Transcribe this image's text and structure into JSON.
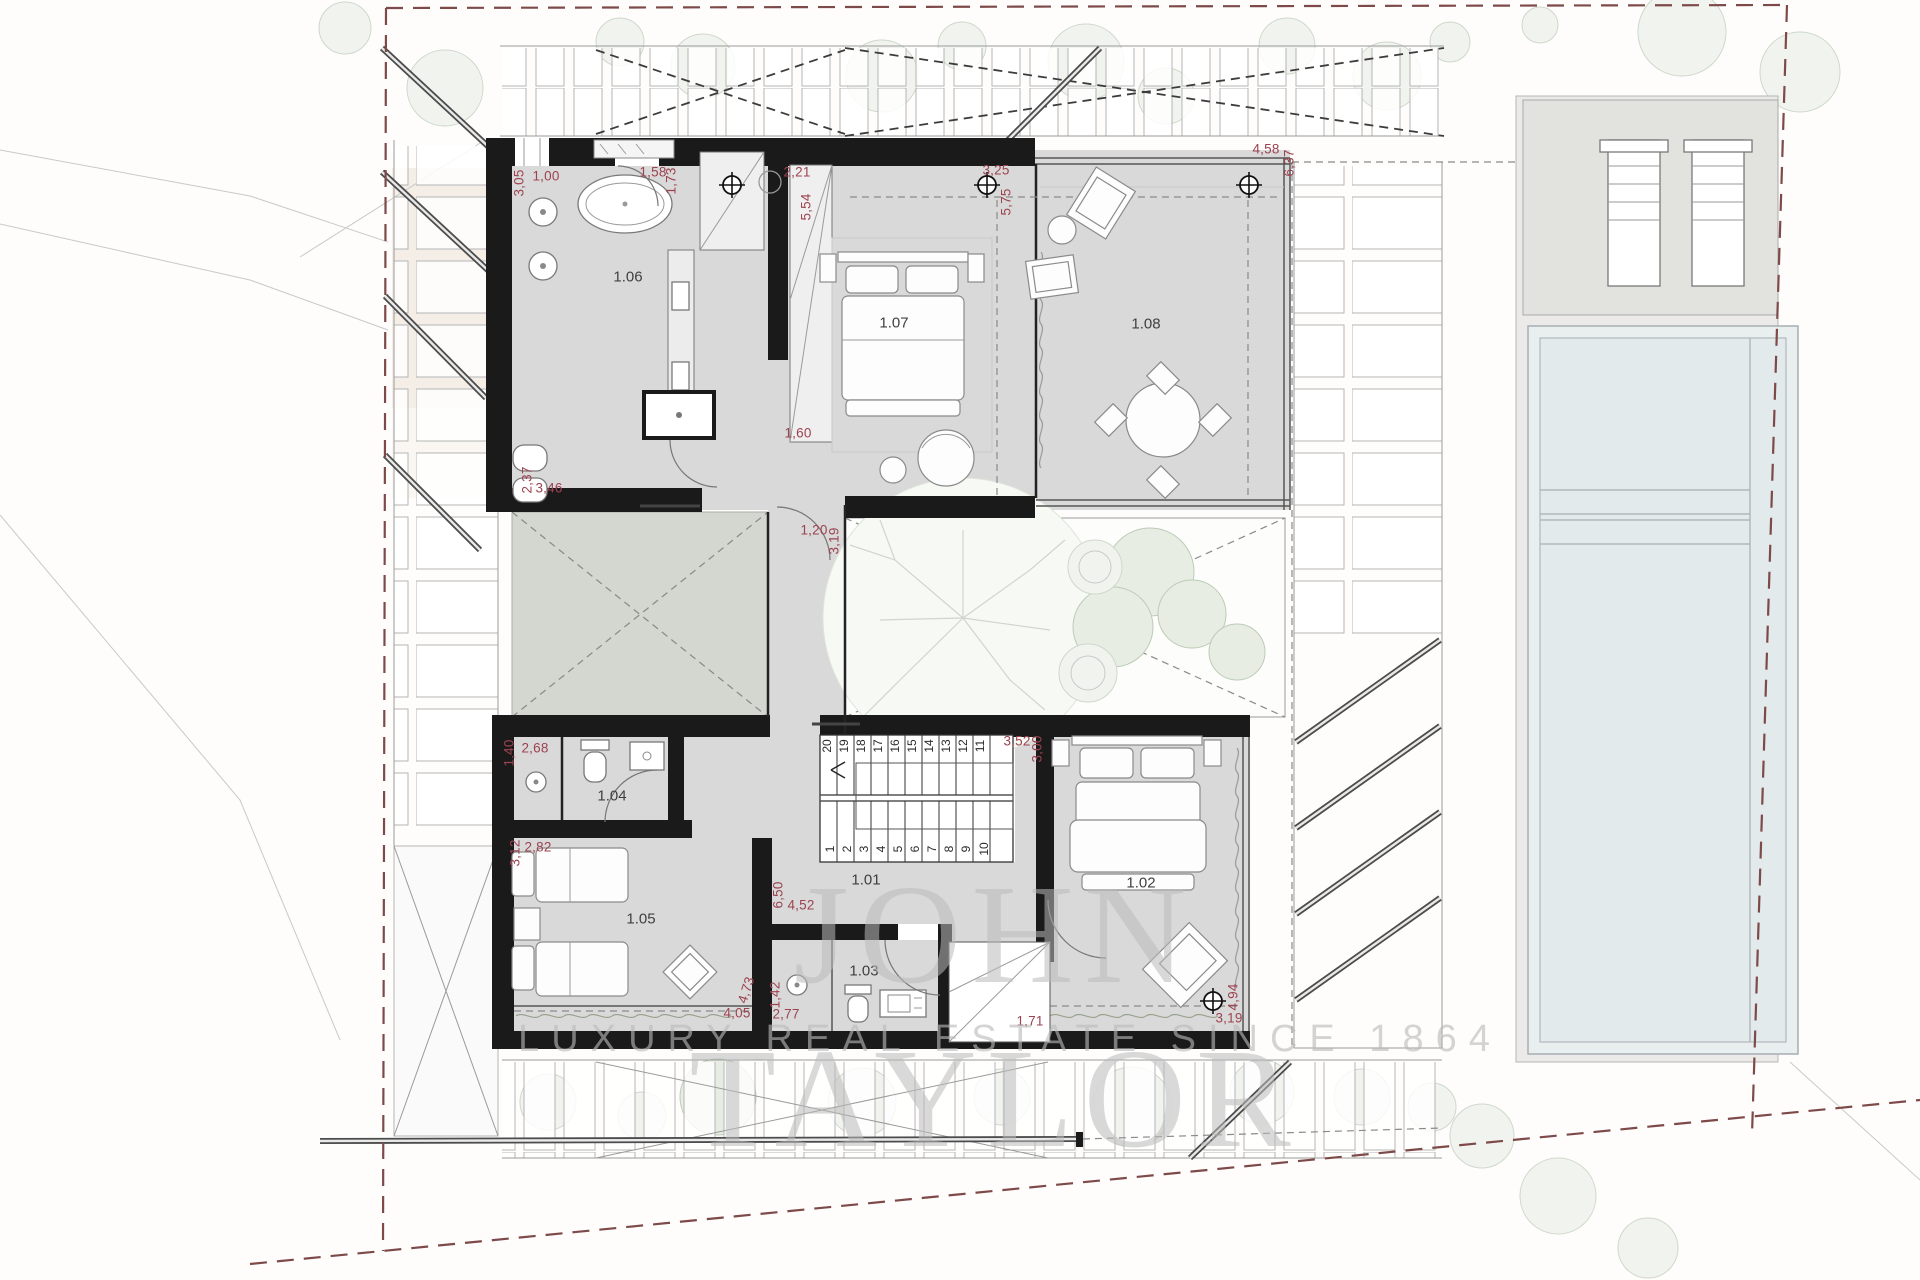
{
  "watermark": {
    "brand": "JOHN TAYLOR",
    "tagline": "LUXURY REAL ESTATE SINCE 1864"
  },
  "palette": {
    "dimension_text": "#9c4350",
    "room_text": "#3f3f3f",
    "wall": "#1a1a1a",
    "floor": "#d9d9d9",
    "patio": "#d4d7cf",
    "pool_water": "#e3eaec",
    "boundary_dash": "#7d4a49",
    "tree": "#ced8cb",
    "watermark": "#bababa"
  },
  "room_labels": [
    {
      "text": "1.01",
      "x": 866,
      "y": 880
    },
    {
      "text": "1.02",
      "x": 1141,
      "y": 883
    },
    {
      "text": "1.03",
      "x": 864,
      "y": 971
    },
    {
      "text": "1.04",
      "x": 612,
      "y": 796
    },
    {
      "text": "1.05",
      "x": 641,
      "y": 919
    },
    {
      "text": "1.06",
      "x": 628,
      "y": 277
    },
    {
      "text": "1.07",
      "x": 894,
      "y": 323
    },
    {
      "text": "1.08",
      "x": 1146,
      "y": 324
    }
  ],
  "dimension_labels": [
    {
      "text": "3,05",
      "x": 519,
      "y": 183,
      "rot": -90
    },
    {
      "text": "1,00",
      "x": 546,
      "y": 176
    },
    {
      "text": "1,58",
      "x": 653,
      "y": 172
    },
    {
      "text": "1,73",
      "x": 671,
      "y": 181,
      "rot": -90
    },
    {
      "text": "2,21",
      "x": 797,
      "y": 172
    },
    {
      "text": "5,54",
      "x": 806,
      "y": 207,
      "rot": -90
    },
    {
      "text": "3,25",
      "x": 996,
      "y": 170
    },
    {
      "text": "5,75",
      "x": 1006,
      "y": 202,
      "rot": -90
    },
    {
      "text": "4,58",
      "x": 1266,
      "y": 149
    },
    {
      "text": "6,37",
      "x": 1289,
      "y": 163,
      "rot": -90
    },
    {
      "text": "1,60",
      "x": 798,
      "y": 433
    },
    {
      "text": "2,37",
      "x": 527,
      "y": 480,
      "rot": -90
    },
    {
      "text": "3,46",
      "x": 549,
      "y": 488
    },
    {
      "text": "1,20",
      "x": 814,
      "y": 530
    },
    {
      "text": "3,19",
      "x": 834,
      "y": 541,
      "rot": -90
    },
    {
      "text": "1,40",
      "x": 509,
      "y": 753,
      "rot": -90
    },
    {
      "text": "2,68",
      "x": 535,
      "y": 748
    },
    {
      "text": "3,12",
      "x": 515,
      "y": 853,
      "rot": -90
    },
    {
      "text": "2,82",
      "x": 538,
      "y": 847
    },
    {
      "text": "3,52",
      "x": 1017,
      "y": 741
    },
    {
      "text": "3,00",
      "x": 1037,
      "y": 749,
      "rot": -90
    },
    {
      "text": "6,50",
      "x": 778,
      "y": 895,
      "rot": -90
    },
    {
      "text": "4,52",
      "x": 801,
      "y": 905
    },
    {
      "text": "4,73",
      "x": 746,
      "y": 990,
      "rot": -72
    },
    {
      "text": "4,05",
      "x": 737,
      "y": 1013
    },
    {
      "text": "1,42",
      "x": 775,
      "y": 995,
      "rot": -90
    },
    {
      "text": "2,77",
      "x": 786,
      "y": 1014
    },
    {
      "text": "1,71",
      "x": 1030,
      "y": 1021
    },
    {
      "text": "4,94",
      "x": 1233,
      "y": 997,
      "rot": -90
    },
    {
      "text": "3,19",
      "x": 1229,
      "y": 1018
    }
  ],
  "stair_labels": [
    {
      "text": "20",
      "x": 827,
      "y": 746,
      "rot": -90
    },
    {
      "text": "19",
      "x": 844,
      "y": 746,
      "rot": -90
    },
    {
      "text": "18",
      "x": 861,
      "y": 746,
      "rot": -90
    },
    {
      "text": "17",
      "x": 878,
      "y": 746,
      "rot": -90
    },
    {
      "text": "16",
      "x": 895,
      "y": 746,
      "rot": -90
    },
    {
      "text": "15",
      "x": 912,
      "y": 746,
      "rot": -90
    },
    {
      "text": "14",
      "x": 929,
      "y": 746,
      "rot": -90
    },
    {
      "text": "13",
      "x": 946,
      "y": 746,
      "rot": -90
    },
    {
      "text": "12",
      "x": 963,
      "y": 746,
      "rot": -90
    },
    {
      "text": "11",
      "x": 980,
      "y": 746,
      "rot": -90
    },
    {
      "text": "1",
      "x": 830,
      "y": 849,
      "rot": -90
    },
    {
      "text": "2",
      "x": 847,
      "y": 849,
      "rot": -90
    },
    {
      "text": "3",
      "x": 864,
      "y": 849,
      "rot": -90
    },
    {
      "text": "4",
      "x": 881,
      "y": 849,
      "rot": -90
    },
    {
      "text": "5",
      "x": 898,
      "y": 849,
      "rot": -90
    },
    {
      "text": "6",
      "x": 915,
      "y": 849,
      "rot": -90
    },
    {
      "text": "7",
      "x": 932,
      "y": 849,
      "rot": -90
    },
    {
      "text": "8",
      "x": 949,
      "y": 849,
      "rot": -90
    },
    {
      "text": "9",
      "x": 966,
      "y": 849,
      "rot": -90
    },
    {
      "text": "10",
      "x": 984,
      "y": 849,
      "rot": -90
    }
  ]
}
